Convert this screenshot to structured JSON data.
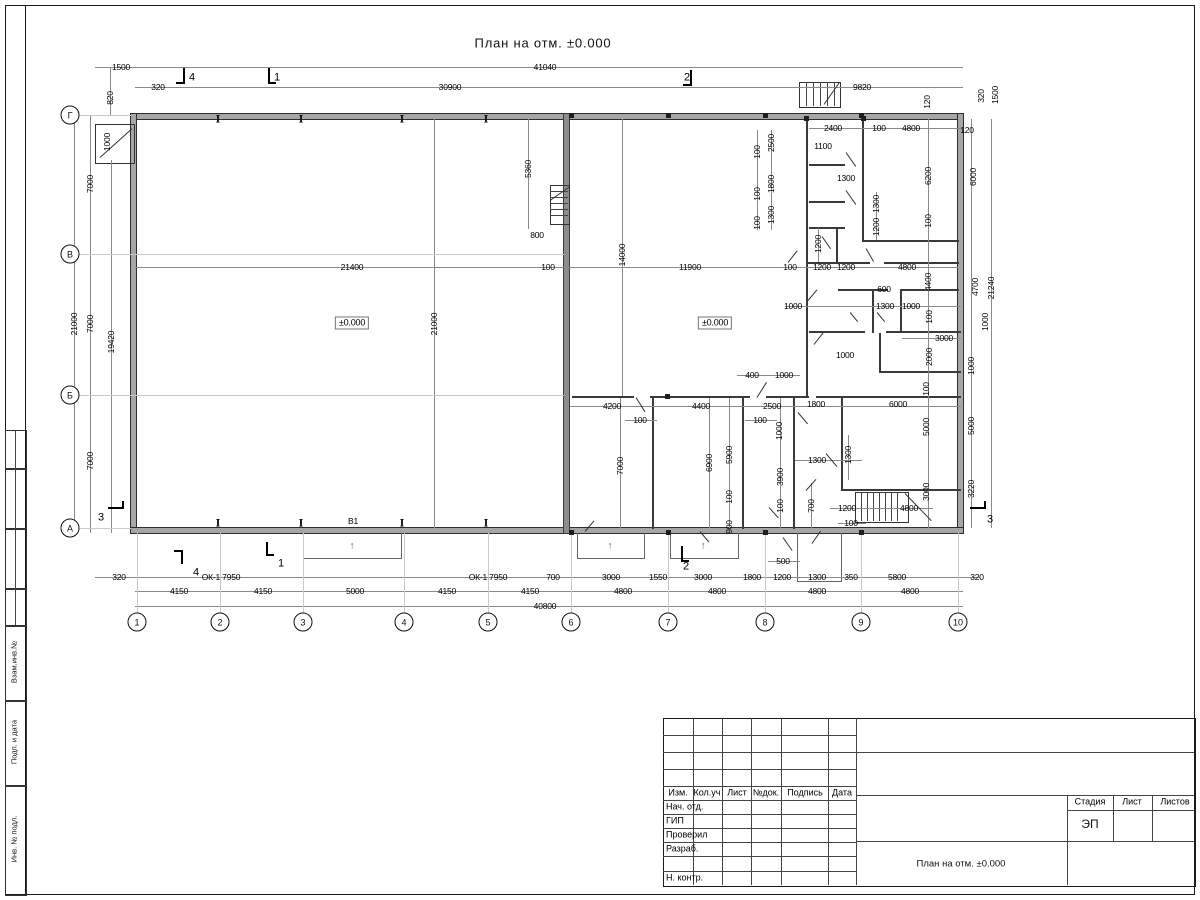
{
  "sheet": {
    "title": "План на отм. ±0.000"
  },
  "titleblock": {
    "header_cols": [
      "Изм.",
      "Кол.уч",
      "Лист",
      "№док.",
      "Подпись",
      "Дата"
    ],
    "rows": [
      "Нач. отд.",
      "ГИП",
      "Проверил",
      "Разраб.",
      "Н. контр."
    ],
    "stage_label": "Стадия",
    "sheet_label": "Лист",
    "sheets_label": "Листов",
    "stage_value": "ЭП",
    "drawing_title": "План на отм. ±0.000"
  },
  "margin": {
    "labels": [
      "Взам.инв.№",
      "Подп. и дата",
      "Инв. № подл."
    ]
  },
  "plan": {
    "axes_bottom": [
      {
        "l": "1",
        "x": 137
      },
      {
        "l": "2",
        "x": 220
      },
      {
        "l": "3",
        "x": 303
      },
      {
        "l": "4",
        "x": 404
      },
      {
        "l": "5",
        "x": 488
      },
      {
        "l": "6",
        "x": 571
      },
      {
        "l": "7",
        "x": 668
      },
      {
        "l": "8",
        "x": 765
      },
      {
        "l": "9",
        "x": 861
      },
      {
        "l": "10",
        "x": 958
      }
    ],
    "axes_left": [
      {
        "l": "Г",
        "y": 115
      },
      {
        "l": "В",
        "y": 254
      },
      {
        "l": "Б",
        "y": 395
      },
      {
        "l": "А",
        "y": 528
      }
    ],
    "porch_arrows": [
      {
        "x": 352,
        "y": 546
      },
      {
        "x": 610,
        "y": 546
      },
      {
        "x": 703,
        "y": 546
      }
    ],
    "annotations": [
      {
        "t": "1500",
        "x": 121,
        "y": 67
      },
      {
        "t": "41040",
        "x": 545,
        "y": 67
      },
      {
        "t": "320",
        "x": 158,
        "y": 87
      },
      {
        "t": "4",
        "x": 192,
        "y": 78,
        "s": 1
      },
      {
        "t": "1",
        "x": 277,
        "y": 78,
        "s": 1
      },
      {
        "t": "30900",
        "x": 450,
        "y": 87
      },
      {
        "t": "2",
        "x": 687,
        "y": 78,
        "s": 1
      },
      {
        "t": "9820",
        "x": 862,
        "y": 87
      },
      {
        "t": "820",
        "x": 110,
        "y": 98,
        "r": 1
      },
      {
        "t": "1000",
        "x": 107,
        "y": 142,
        "r": 1
      },
      {
        "t": "120",
        "x": 927,
        "y": 102,
        "r": 1
      },
      {
        "t": "320",
        "x": 981,
        "y": 96,
        "r": 1
      },
      {
        "t": "1500",
        "x": 995,
        "y": 95,
        "r": 1
      },
      {
        "t": "120",
        "x": 967,
        "y": 130
      },
      {
        "t": "2400",
        "x": 833,
        "y": 128
      },
      {
        "t": "100",
        "x": 879,
        "y": 128
      },
      {
        "t": "4800",
        "x": 911,
        "y": 128
      },
      {
        "t": "2500",
        "x": 771,
        "y": 143,
        "r": 1
      },
      {
        "t": "100",
        "x": 757,
        "y": 152,
        "r": 1
      },
      {
        "t": "1100",
        "x": 823,
        "y": 146
      },
      {
        "t": "1300",
        "x": 846,
        "y": 178
      },
      {
        "t": "1800",
        "x": 771,
        "y": 184,
        "r": 1
      },
      {
        "t": "100",
        "x": 757,
        "y": 194,
        "r": 1
      },
      {
        "t": "1300",
        "x": 771,
        "y": 215,
        "r": 1
      },
      {
        "t": "100",
        "x": 757,
        "y": 223,
        "r": 1
      },
      {
        "t": "1300",
        "x": 876,
        "y": 204,
        "r": 1
      },
      {
        "t": "1200",
        "x": 876,
        "y": 227,
        "r": 1
      },
      {
        "t": "6200",
        "x": 928,
        "y": 176,
        "r": 1
      },
      {
        "t": "6000",
        "x": 973,
        "y": 177,
        "r": 1
      },
      {
        "t": "100",
        "x": 928,
        "y": 221,
        "r": 1
      },
      {
        "t": "1200",
        "x": 818,
        "y": 244,
        "r": 1
      },
      {
        "t": "100",
        "x": 790,
        "y": 267
      },
      {
        "t": "1200",
        "x": 822,
        "y": 267
      },
      {
        "t": "1200",
        "x": 846,
        "y": 267
      },
      {
        "t": "4800",
        "x": 907,
        "y": 267
      },
      {
        "t": "4400",
        "x": 928,
        "y": 282,
        "r": 1
      },
      {
        "t": "4700",
        "x": 975,
        "y": 287,
        "r": 1
      },
      {
        "t": "21240",
        "x": 991,
        "y": 288,
        "r": 1
      },
      {
        "t": "600",
        "x": 884,
        "y": 289
      },
      {
        "t": "1000",
        "x": 793,
        "y": 306
      },
      {
        "t": "1300",
        "x": 885,
        "y": 306
      },
      {
        "t": "1000",
        "x": 911,
        "y": 306
      },
      {
        "t": "100",
        "x": 929,
        "y": 317,
        "r": 1
      },
      {
        "t": "1000",
        "x": 985,
        "y": 322,
        "r": 1
      },
      {
        "t": "3000",
        "x": 944,
        "y": 338
      },
      {
        "t": "2000",
        "x": 929,
        "y": 357,
        "r": 1
      },
      {
        "t": "1000",
        "x": 845,
        "y": 355
      },
      {
        "t": "1000",
        "x": 971,
        "y": 366,
        "r": 1
      },
      {
        "t": "5360",
        "x": 528,
        "y": 169,
        "r": 1
      },
      {
        "t": "800",
        "x": 537,
        "y": 235
      },
      {
        "t": "21400",
        "x": 352,
        "y": 267
      },
      {
        "t": "100",
        "x": 548,
        "y": 267
      },
      {
        "t": "14000",
        "x": 622,
        "y": 255,
        "r": 1
      },
      {
        "t": "11900",
        "x": 690,
        "y": 267
      },
      {
        "t": "±0.000",
        "x": 352,
        "y": 323,
        "b": 1
      },
      {
        "t": "±0.000",
        "x": 715,
        "y": 323,
        "b": 1
      },
      {
        "t": "21000",
        "x": 434,
        "y": 324,
        "r": 1
      },
      {
        "t": "7000",
        "x": 90,
        "y": 184,
        "r": 1
      },
      {
        "t": "21000",
        "x": 74,
        "y": 324,
        "r": 1
      },
      {
        "t": "7000",
        "x": 90,
        "y": 324,
        "r": 1
      },
      {
        "t": "19420",
        "x": 111,
        "y": 342,
        "r": 1
      },
      {
        "t": "7000",
        "x": 90,
        "y": 461,
        "r": 1
      },
      {
        "t": "3",
        "x": 101,
        "y": 518,
        "s": 1
      },
      {
        "t": "400",
        "x": 752,
        "y": 375
      },
      {
        "t": "1000",
        "x": 784,
        "y": 375
      },
      {
        "t": "4200",
        "x": 612,
        "y": 406
      },
      {
        "t": "4400",
        "x": 701,
        "y": 406
      },
      {
        "t": "2500",
        "x": 772,
        "y": 406
      },
      {
        "t": "100",
        "x": 640,
        "y": 420
      },
      {
        "t": "100",
        "x": 760,
        "y": 420
      },
      {
        "t": "1000",
        "x": 779,
        "y": 431,
        "r": 1
      },
      {
        "t": "7000",
        "x": 620,
        "y": 466,
        "r": 1
      },
      {
        "t": "6900",
        "x": 709,
        "y": 463,
        "r": 1
      },
      {
        "t": "5900",
        "x": 729,
        "y": 455,
        "r": 1
      },
      {
        "t": "3900",
        "x": 780,
        "y": 477,
        "r": 1
      },
      {
        "t": "100",
        "x": 729,
        "y": 497,
        "r": 1
      },
      {
        "t": "100",
        "x": 780,
        "y": 506,
        "r": 1
      },
      {
        "t": "900",
        "x": 729,
        "y": 527,
        "r": 1
      },
      {
        "t": "700",
        "x": 811,
        "y": 506,
        "r": 1
      },
      {
        "t": "1300",
        "x": 817,
        "y": 460
      },
      {
        "t": "1300",
        "x": 848,
        "y": 455,
        "r": 1
      },
      {
        "t": "1200",
        "x": 847,
        "y": 508
      },
      {
        "t": "100",
        "x": 851,
        "y": 523
      },
      {
        "t": "1800",
        "x": 816,
        "y": 404
      },
      {
        "t": "6000",
        "x": 898,
        "y": 404
      },
      {
        "t": "100",
        "x": 926,
        "y": 389,
        "r": 1
      },
      {
        "t": "5000",
        "x": 926,
        "y": 427,
        "r": 1
      },
      {
        "t": "5000",
        "x": 971,
        "y": 426,
        "r": 1
      },
      {
        "t": "3000",
        "x": 926,
        "y": 492,
        "r": 1
      },
      {
        "t": "3220",
        "x": 971,
        "y": 489,
        "r": 1
      },
      {
        "t": "4800",
        "x": 909,
        "y": 508
      },
      {
        "t": "3",
        "x": 990,
        "y": 520,
        "s": 1
      },
      {
        "t": "320",
        "x": 119,
        "y": 577
      },
      {
        "t": "ОК-1 7950",
        "x": 221,
        "y": 577
      },
      {
        "t": "ОК-1 7950",
        "x": 488,
        "y": 577
      },
      {
        "t": "700",
        "x": 553,
        "y": 577
      },
      {
        "t": "3000",
        "x": 611,
        "y": 577
      },
      {
        "t": "1550",
        "x": 658,
        "y": 577
      },
      {
        "t": "2",
        "x": 686,
        "y": 567,
        "s": 1
      },
      {
        "t": "3000",
        "x": 703,
        "y": 577
      },
      {
        "t": "1800",
        "x": 752,
        "y": 577
      },
      {
        "t": "1200",
        "x": 782,
        "y": 577
      },
      {
        "t": "1300",
        "x": 817,
        "y": 577
      },
      {
        "t": "350",
        "x": 851,
        "y": 577
      },
      {
        "t": "5800",
        "x": 897,
        "y": 577
      },
      {
        "t": "320",
        "x": 977,
        "y": 577
      },
      {
        "t": "500",
        "x": 783,
        "y": 561
      },
      {
        "t": "4",
        "x": 196,
        "y": 573,
        "s": 1
      },
      {
        "t": "1",
        "x": 281,
        "y": 564,
        "s": 1
      },
      {
        "t": "4150",
        "x": 179,
        "y": 591
      },
      {
        "t": "4150",
        "x": 263,
        "y": 591
      },
      {
        "t": "5000",
        "x": 355,
        "y": 591
      },
      {
        "t": "4150",
        "x": 447,
        "y": 591
      },
      {
        "t": "4150",
        "x": 530,
        "y": 591
      },
      {
        "t": "4800",
        "x": 623,
        "y": 591
      },
      {
        "t": "4800",
        "x": 717,
        "y": 591
      },
      {
        "t": "4800",
        "x": 817,
        "y": 591
      },
      {
        "t": "4800",
        "x": 910,
        "y": 591
      },
      {
        "t": "40800",
        "x": 545,
        "y": 606
      },
      {
        "t": "В1",
        "x": 353,
        "y": 521
      }
    ]
  }
}
